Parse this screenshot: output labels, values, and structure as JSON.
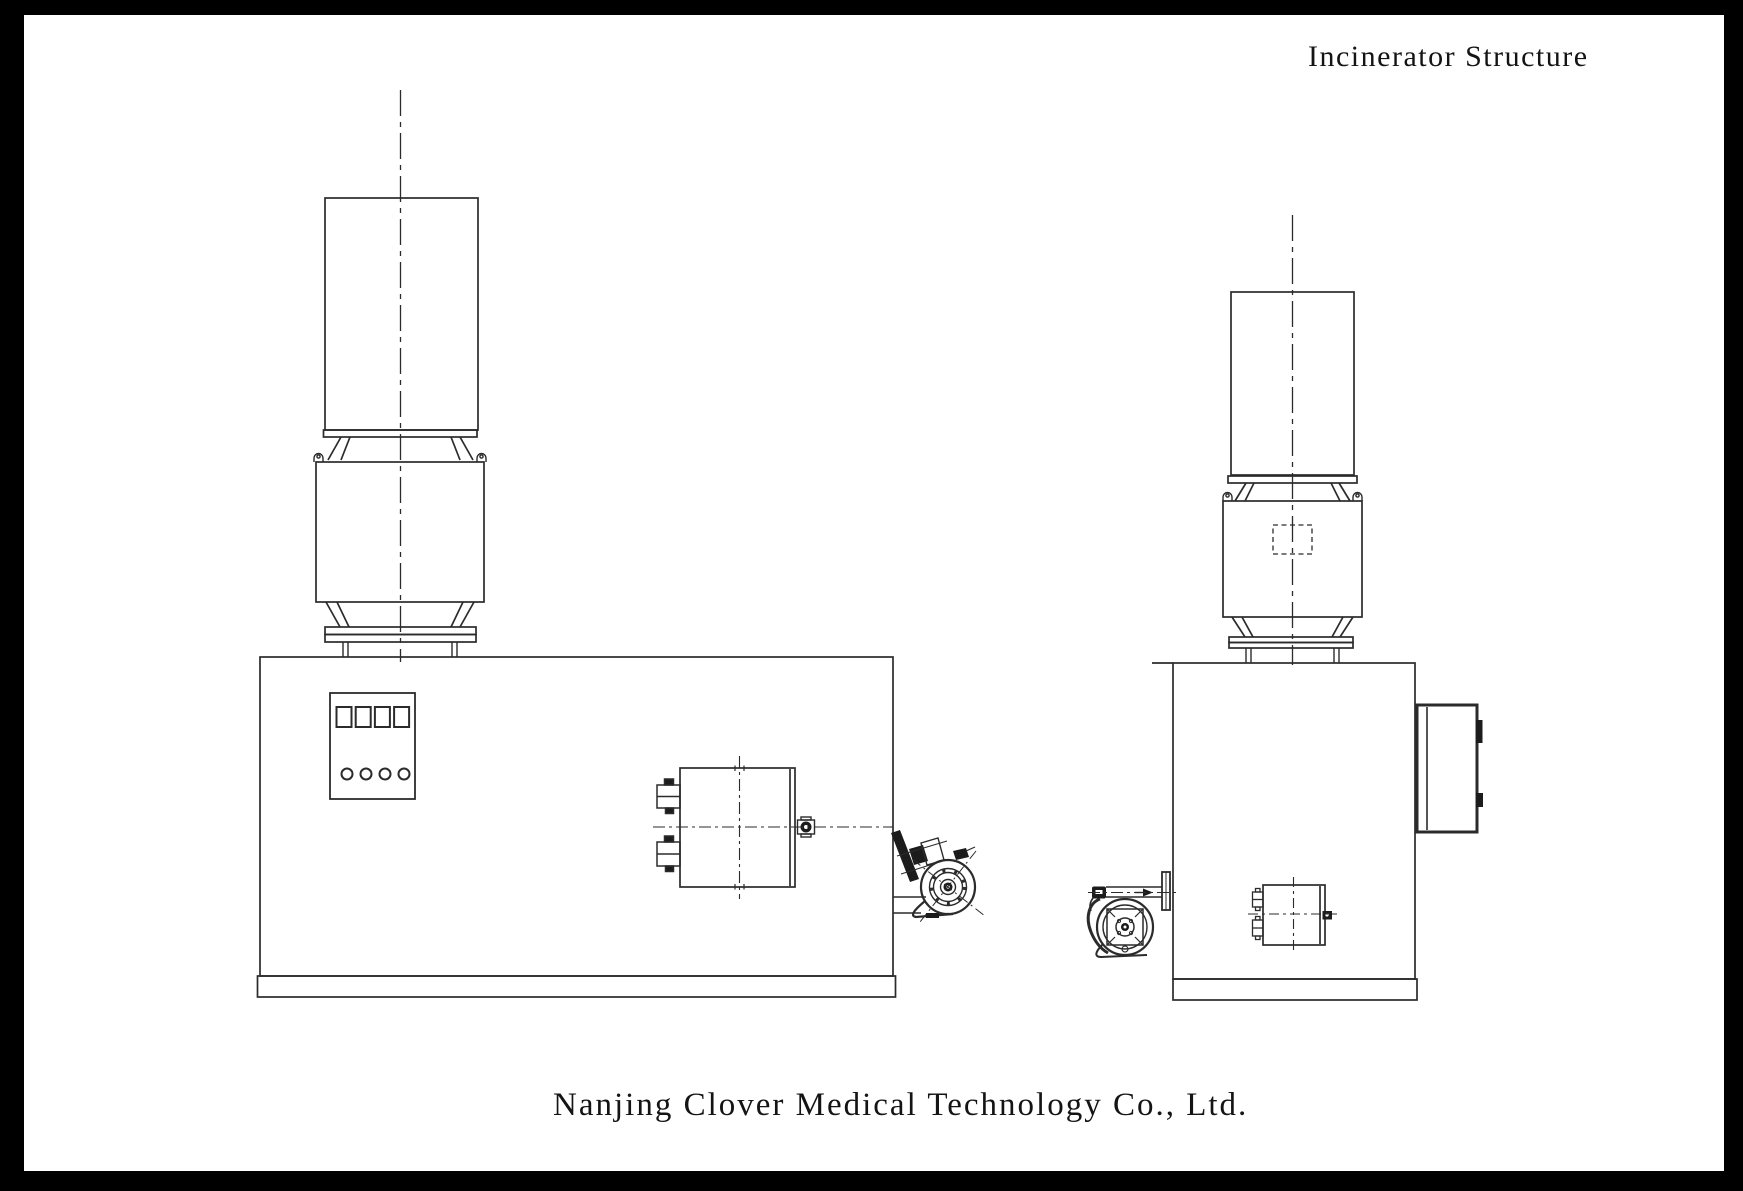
{
  "page": {
    "title": "Incinerator Structure",
    "footer": "Nanjing Clover Medical Technology Co., Ltd."
  },
  "colors": {
    "frame": "#000000",
    "paper": "#ffffff",
    "ink": "#2b2b2b"
  }
}
